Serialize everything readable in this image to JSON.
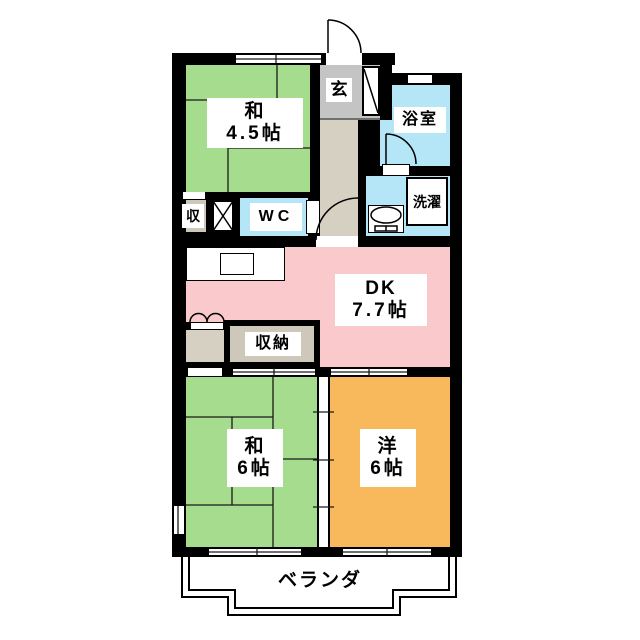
{
  "rooms": {
    "washitsu45": {
      "line1": "和",
      "line2": "4.5帖"
    },
    "washitsu6": {
      "line1": "和",
      "line2": "6帖"
    },
    "youshitsu6": {
      "line1": "洋",
      "line2": "6帖"
    },
    "dk": {
      "line1": "DK",
      "line2": "7.7帖"
    },
    "genkan": {
      "label": "玄"
    },
    "bathroom": {
      "label": "浴室"
    },
    "laundry": {
      "label": "洗濯"
    },
    "wc": {
      "label": "WC"
    },
    "storage_small": {
      "label": "収"
    },
    "storage_closet": {
      "label": "収納"
    },
    "veranda": {
      "label": "ベランダ"
    }
  },
  "colors": {
    "tatami_room": "#a6dc8e",
    "dk": "#f9c9cb",
    "western_room": "#f8b95c",
    "wet_area": "#b4e6f8",
    "genkan": "#c4c4c4",
    "hallway": "#d5d0c1",
    "closet": "#cdc8b9",
    "wall": "#000000"
  }
}
